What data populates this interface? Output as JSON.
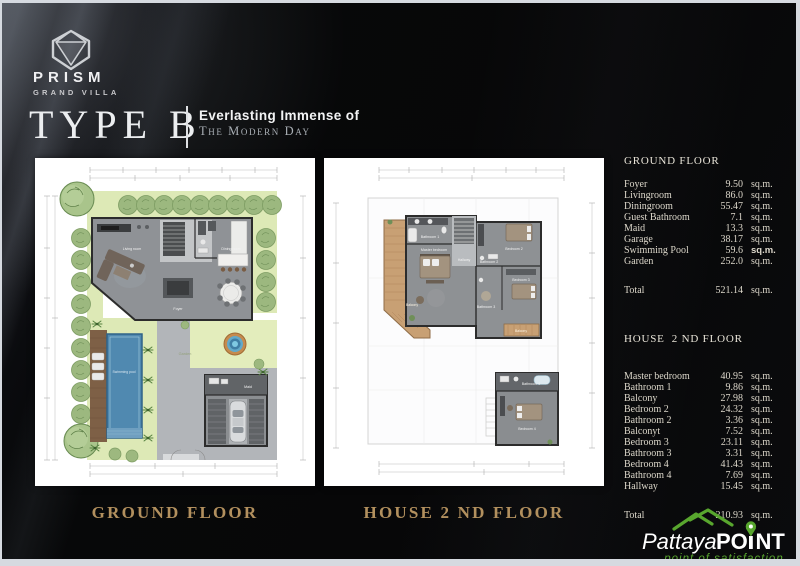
{
  "brand": {
    "name": "PRISM",
    "subtitle": "GRAND VILLA"
  },
  "title": {
    "text": "TYPE B",
    "tagline1": "Everlasting Immense of",
    "tagline2": "The Modern Day"
  },
  "plans": {
    "ground": {
      "caption": "GROUND FLOOR",
      "labels": {
        "living": "Living room",
        "dining": "Dining room",
        "foyer": "Foyer",
        "garden": "Garden",
        "pool": "Swimming pool",
        "maid": "Maid"
      }
    },
    "second": {
      "caption": "HOUSE 2 ND FLOOR",
      "labels": {
        "master": "Master bedroom",
        "bath1": "Bathroom 1",
        "bed2": "Bedroom 2",
        "bath2": "Bathroom 2",
        "bed3": "Bedroom 3",
        "bath3": "Bathroom 3",
        "bed4": "Bedroom 4",
        "bath4": "Bathroom 4",
        "balcony": "Balcony",
        "hallway": "Hallway"
      }
    }
  },
  "tables": {
    "ground": {
      "header": "GROUND FLOOR",
      "rows": [
        {
          "label": "Foyer",
          "value": "9.50",
          "unit": "sq.m."
        },
        {
          "label": "Livingroom",
          "value": "86.0",
          "unit": "sq.m."
        },
        {
          "label": "Diningroom",
          "value": "55.47",
          "unit": "sq.m."
        },
        {
          "label": "Guest Bathroom",
          "value": "7.1",
          "unit": "sq.m."
        },
        {
          "label": "Maid",
          "value": "13.3",
          "unit": "sq.m."
        },
        {
          "label": "Garage",
          "value": "38.17",
          "unit": "sq.m."
        },
        {
          "label": "Swimming Pool",
          "value": "59.6",
          "unit": "sq.m.",
          "unit_bold": true
        },
        {
          "label": "Garden",
          "value": "252.0",
          "unit": "sq.m."
        }
      ],
      "total": {
        "label": "Total",
        "value": "521.14",
        "unit": "sq.m."
      }
    },
    "second": {
      "header": "HOUSE  2 ND FLOOR",
      "rows": [
        {
          "label": "Master bedroom",
          "value": "40.95",
          "unit": "sq.m."
        },
        {
          "label": "Bathroom 1",
          "value": "9.86",
          "unit": "sq.m."
        },
        {
          "label": "Balcony",
          "value": "27.98",
          "unit": "sq.m."
        },
        {
          "label": "Bedroom 2",
          "value": "24.32",
          "unit": "sq.m."
        },
        {
          "label": "Bathroom 2",
          "value": "3.36",
          "unit": "sq.m."
        },
        {
          "label": "Balconyt",
          "value": "7.52",
          "unit": "sq.m."
        },
        {
          "label": "Bedroom 3",
          "value": "23.11",
          "unit": "sq.m."
        },
        {
          "label": "Bathroom 3",
          "value": "3.31",
          "unit": "sq.m."
        },
        {
          "label": "Bedroom 4",
          "value": "41.43",
          "unit": "sq.m."
        },
        {
          "label": "Bathroom 4",
          "value": "7.69",
          "unit": "sq.m."
        },
        {
          "label": "Hallway",
          "value": "15.45",
          "unit": "sq.m."
        }
      ],
      "total": {
        "label": "Total",
        "value": "210.93",
        "unit": "sq.m."
      }
    }
  },
  "footer_logo": {
    "name_light": "Pattaya",
    "name_bold_left": "PO",
    "name_bold_right": "NT",
    "tagline": "point of satisfaction"
  },
  "colors": {
    "accent_gold": "#b2905e",
    "logo_green": "#58a62e",
    "table_text": "#ddd8cb",
    "garden_green": "#dde9b6",
    "pool_blue": "#5089b0"
  }
}
